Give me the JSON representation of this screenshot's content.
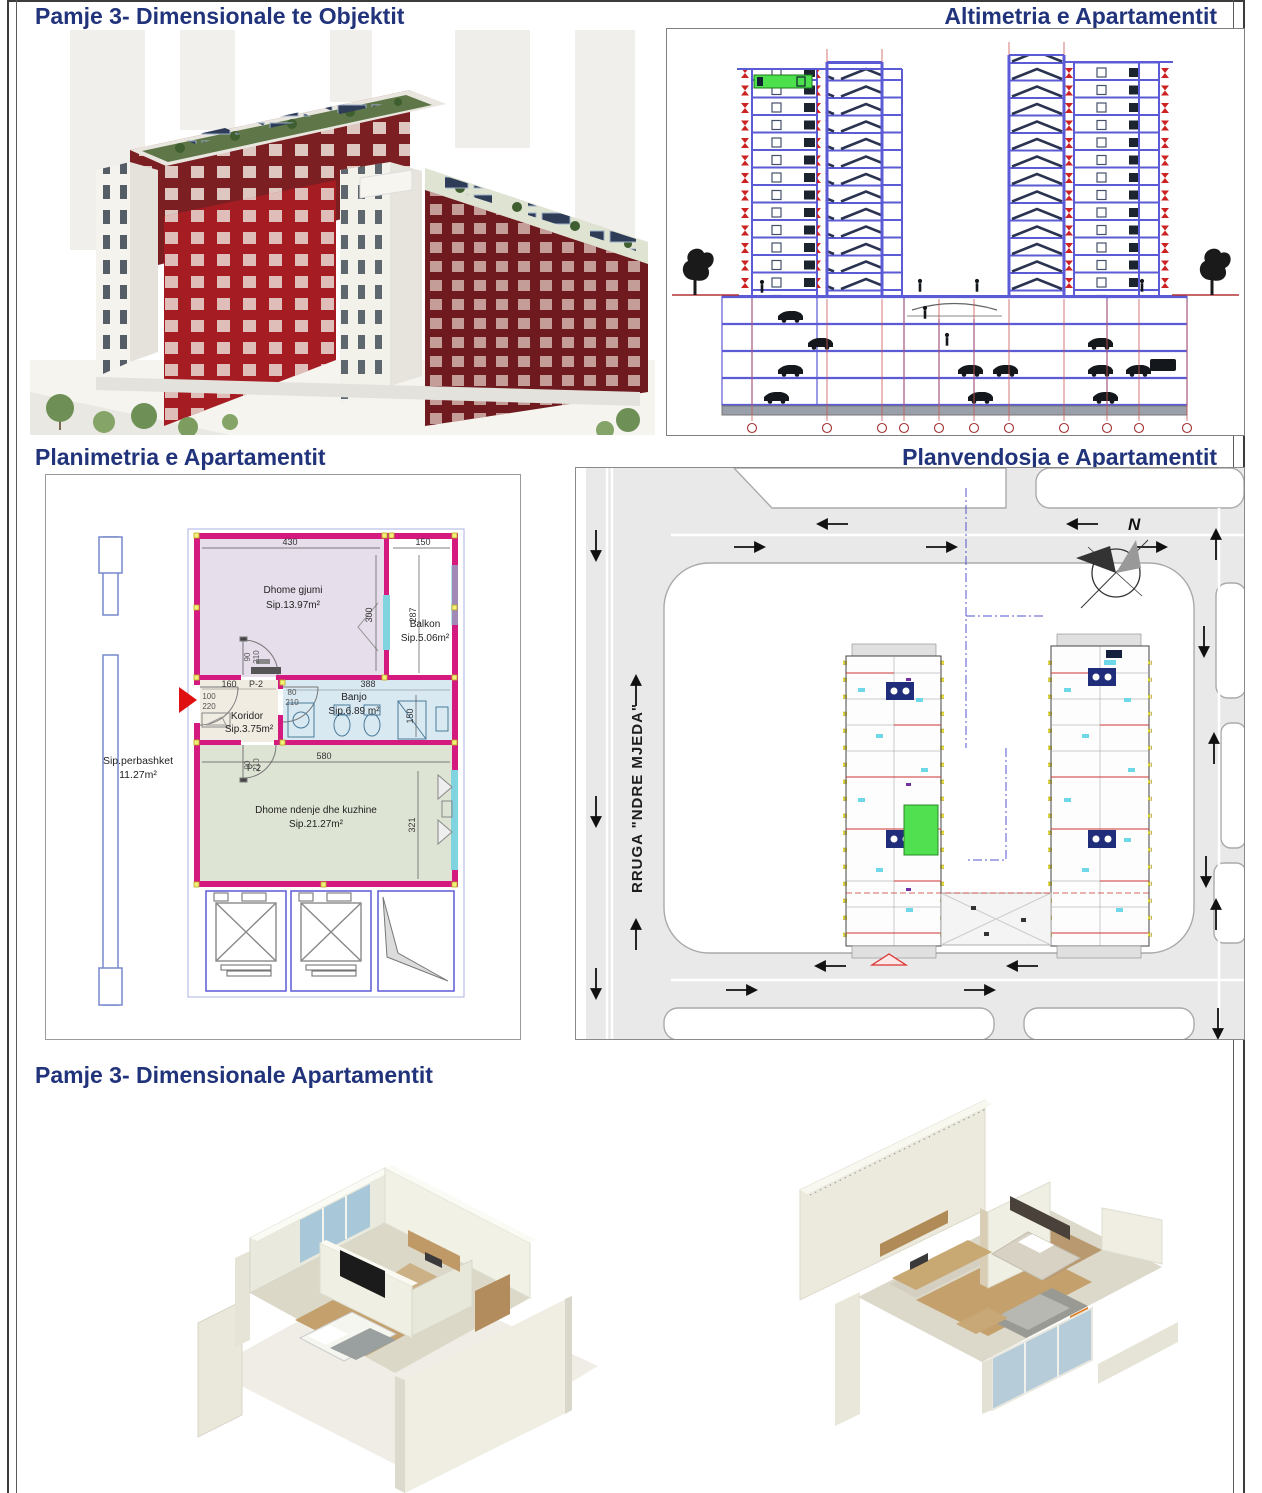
{
  "titles": {
    "building3d": "Pamje 3- Dimensionale te Objektit",
    "elevation": "Altimetria e Apartamentit",
    "floorplan": "Planimetria e Apartamentit",
    "siteplan": "Planvendosja e Apartamentit",
    "apartment3d": "Pamje 3- Dimensionale Apartamentit"
  },
  "floorplan": {
    "rooms": {
      "bedroom": {
        "name": "Dhome gjumi",
        "area": "Sip.13.97m²"
      },
      "balcony": {
        "name": "Balkon",
        "area": "Sip.5.06m²"
      },
      "bath": {
        "name": "Banjo",
        "area": "Sip.6.89 m²"
      },
      "corridor": {
        "name": "Koridor",
        "area": "Sip.3.75m²"
      },
      "living": {
        "name": "Dhome ndenje dhe kuzhine",
        "area": "Sip.21.27m²"
      }
    },
    "common": {
      "label": "Sip.perbashket",
      "value": "11.27m²"
    },
    "dims": {
      "bedroom_w": "430",
      "balcony_w": "150",
      "bedroom_h": "300",
      "balcony_h": "287",
      "corridor_w": "160",
      "bath_w": "388",
      "living_w": "580",
      "bath_h": "150",
      "living_h": "321",
      "entry_w": "100",
      "entry_h": "220",
      "bath_door_w": "80",
      "bath_door_h": "210",
      "bed_door_w": "90",
      "bed_door_h": "210",
      "living_door_w": "90",
      "living_door_h": "210",
      "door_type_bed": "P-2",
      "door_type_living": "P-2"
    }
  },
  "siteplan": {
    "street_name": "RRUGA \"NDRE MJEDA\"",
    "compass_north": "N"
  },
  "colors": {
    "title_navy": "#21337b",
    "facade_red": "#7c1f22",
    "facade_bright_red": "#a51d23",
    "drawing_blue": "#5b5bd6",
    "marker_red": "#cc2222",
    "highlight_green": "#4ce04c",
    "wall_magenta": "#d41a7e",
    "room_bedroom": "#e7deeb",
    "room_bath": "#d9e9f2",
    "room_living": "#dee4d4",
    "room_corridor": "#f1ece2",
    "road_gray": "#e9e9e9"
  }
}
